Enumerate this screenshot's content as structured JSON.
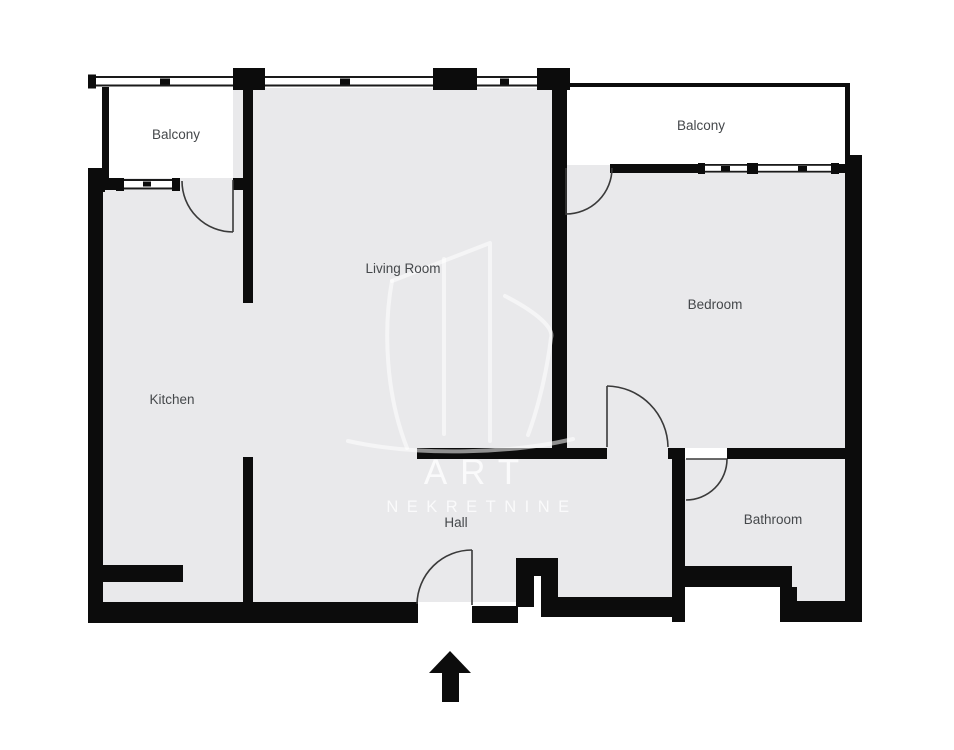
{
  "meta": {
    "type": "real-estate floor plan",
    "colors": {
      "background": "#ffffff",
      "floor": "#e9e9eb",
      "wall": "#0c0c0c",
      "label_text": "#45484b",
      "watermark": "#ffffff"
    }
  },
  "rooms": {
    "balcony_left": {
      "label": "Balcony"
    },
    "balcony_right": {
      "label": "Balcony"
    },
    "living_room": {
      "label": "Living Room"
    },
    "bedroom": {
      "label": "Bedroom"
    },
    "kitchen": {
      "label": "Kitchen"
    },
    "hall": {
      "label": "Hall"
    },
    "bathroom": {
      "label": "Bathroom"
    }
  },
  "watermark": {
    "line1": "ART",
    "line2": "NEKRETNINE"
  },
  "entrance": {
    "icon": "up-arrow-icon"
  }
}
